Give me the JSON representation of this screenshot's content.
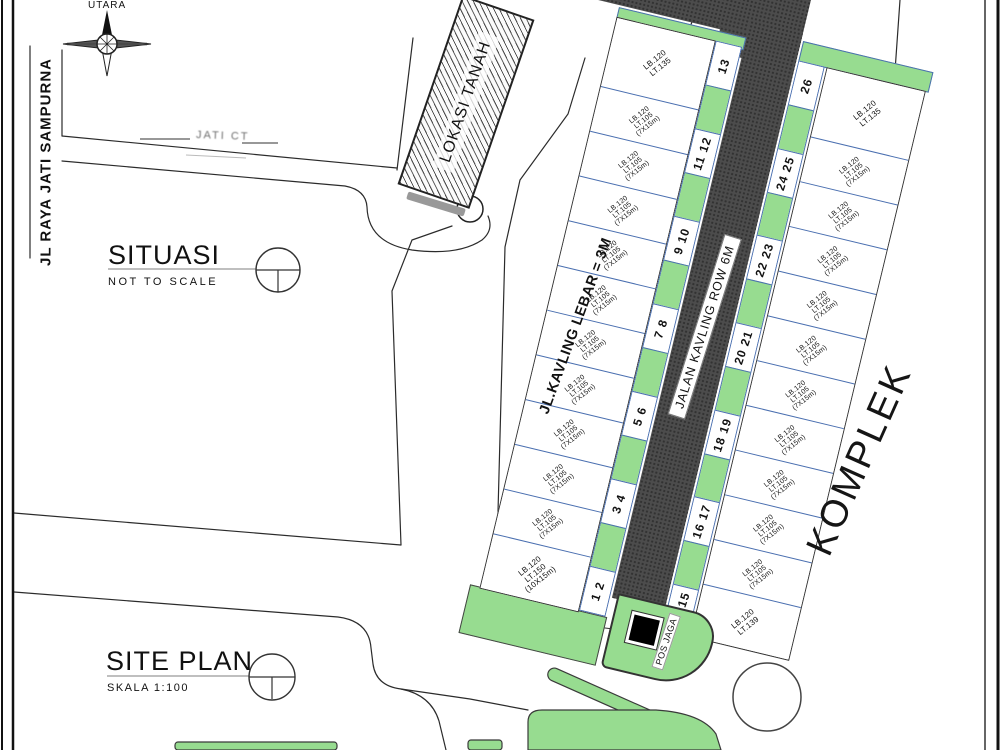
{
  "labels": {
    "compass": "UTARA",
    "left_road": "JL RAYA JATI SAMPURNA",
    "faint_road": "JATI CT",
    "situasi_title": "SITUASI",
    "situasi_note": "NOT TO SCALE",
    "siteplan_title": "SITE PLAN",
    "siteplan_scale": "SKALA 1:100",
    "lokasi": "LOKASI TANAH",
    "komplek": "KOMPLEK",
    "pos_jaga": "POS JAGA",
    "kavling_street": "JL.KAVLING LEBAR = 3M",
    "kavling_road": "JALAN KAVLING ROW 6M"
  },
  "kavling": {
    "left_numbers": [
      "13",
      "11 12",
      "9 10",
      "7 8",
      "5 6",
      "3 4",
      "1 2"
    ],
    "right_numbers": [
      "26",
      "24 25",
      "22 23",
      "20 21",
      "18 19",
      "16 17",
      "14 15"
    ],
    "left_plots": [
      {
        "lines": [
          "LB.120",
          "LT.135"
        ]
      },
      {
        "lines": [
          "LB.120",
          "LT.105",
          "(7X15m)"
        ]
      },
      {
        "lines": [
          "LB.120",
          "LT.105",
          "(7X15m)"
        ]
      },
      {
        "lines": [
          "LB.120",
          "LT.105",
          "(7X15m)"
        ]
      },
      {
        "lines": [
          "LB.120",
          "LT.105",
          "(7X15m)"
        ]
      },
      {
        "lines": [
          "LB.120",
          "LT.105",
          "(7X15m)"
        ]
      },
      {
        "lines": [
          "LB.120",
          "LT.105",
          "(7X15m)"
        ]
      },
      {
        "lines": [
          "LB.120",
          "LT.105",
          "(7X15m)"
        ]
      },
      {
        "lines": [
          "LB.120",
          "LT.105",
          "(7X15m)"
        ]
      },
      {
        "lines": [
          "LB.120",
          "LT.105",
          "(7X15m)"
        ]
      },
      {
        "lines": [
          "LB.120",
          "LT.105",
          "(7X15m)"
        ]
      },
      {
        "lines": [
          "LB.120",
          "LT.150",
          "(10X15m)"
        ]
      }
    ],
    "right_plots": [
      {
        "lines": [
          "LB.120",
          "LT.135"
        ]
      },
      {
        "lines": [
          "LB.120",
          "LT.105",
          "(7X15m)"
        ]
      },
      {
        "lines": [
          "LB.120",
          "LT.105",
          "(7X15m)"
        ]
      },
      {
        "lines": [
          "LB.120",
          "LT.105",
          "(7X15m)"
        ]
      },
      {
        "lines": [
          "LB.120",
          "LT.105",
          "(7X15m)"
        ]
      },
      {
        "lines": [
          "LB.120",
          "LT.105",
          "(7X15m)"
        ]
      },
      {
        "lines": [
          "LB.120",
          "LT.105",
          "(7X15m)"
        ]
      },
      {
        "lines": [
          "LB.120",
          "LT.105",
          "(7X15m)"
        ]
      },
      {
        "lines": [
          "LB.120",
          "LT.105",
          "(7X15m)"
        ]
      },
      {
        "lines": [
          "LB.120",
          "LT.105",
          "(7X15m)"
        ]
      },
      {
        "lines": [
          "LB.120",
          "LT.105",
          "(7X15m)"
        ]
      },
      {
        "lines": [
          "LB.120",
          "LT.139"
        ]
      }
    ]
  },
  "colors": {
    "green": "#97DC90",
    "road_dark": "#4C4C4C",
    "cell_border": "#4A6FB0"
  }
}
